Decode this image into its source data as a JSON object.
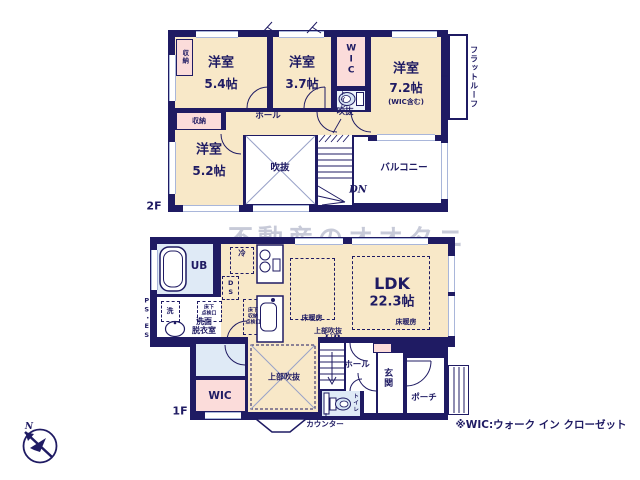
{
  "colors": {
    "wall": "#1f1b63",
    "cream": "#f8e8c8",
    "pink": "#fbdcda",
    "blue": "#dfeaf6",
    "win": "#a9b6da",
    "ink": "#1f1b63",
    "watermark": "#9aa0ba",
    "fixture": "#d7e4f4"
  },
  "watermark": "不動産のオオタニ",
  "note": "※WIC:ウォーク イン クローゼット",
  "compass": {
    "north": "N"
  },
  "floor2": {
    "label": "2F",
    "room_54": {
      "name": "洋室",
      "size": "5.4帖"
    },
    "room_37": {
      "name": "洋室",
      "size": "3.7帖"
    },
    "room_72": {
      "name": "洋室",
      "size": "7.2帖",
      "note": "(WIC含む)"
    },
    "room_52": {
      "name": "洋室",
      "size": "5.2帖"
    },
    "wic": "WIC",
    "toilet": "トイレ",
    "hall": "ホール",
    "void": "吹抜",
    "void_over_stairs": "吹抜",
    "balcony": "バルコニー",
    "flat_roof": "フラットルーフ",
    "closet_side": "収納",
    "closet_mid": "収納",
    "stairs_down": "DN"
  },
  "floor1": {
    "label": "1F",
    "unit_bath": "UB",
    "refrigerator": "冷",
    "duct_space": "DS",
    "laundry": "洗",
    "underfloor_hatch": "床下\n点検口",
    "underfloor_storage_hatch": "床下\n収納\n点検口",
    "washroom": "洗面\n脱衣室",
    "pipe_space": "PS・ES",
    "ldk": {
      "name": "LDK",
      "size": "22.3帖"
    },
    "floor_heating_left": "床暖房",
    "floor_heating_right": "床暖房",
    "upper_void": "上部吹抜",
    "upper_void_stairs": "上部吹抜",
    "stairs_up": "UP",
    "wic": "WIC",
    "toilet": "トイレ",
    "hall": "ホール",
    "entrance": "玄関",
    "porch": "ポーチ",
    "counter": "カウンター"
  }
}
